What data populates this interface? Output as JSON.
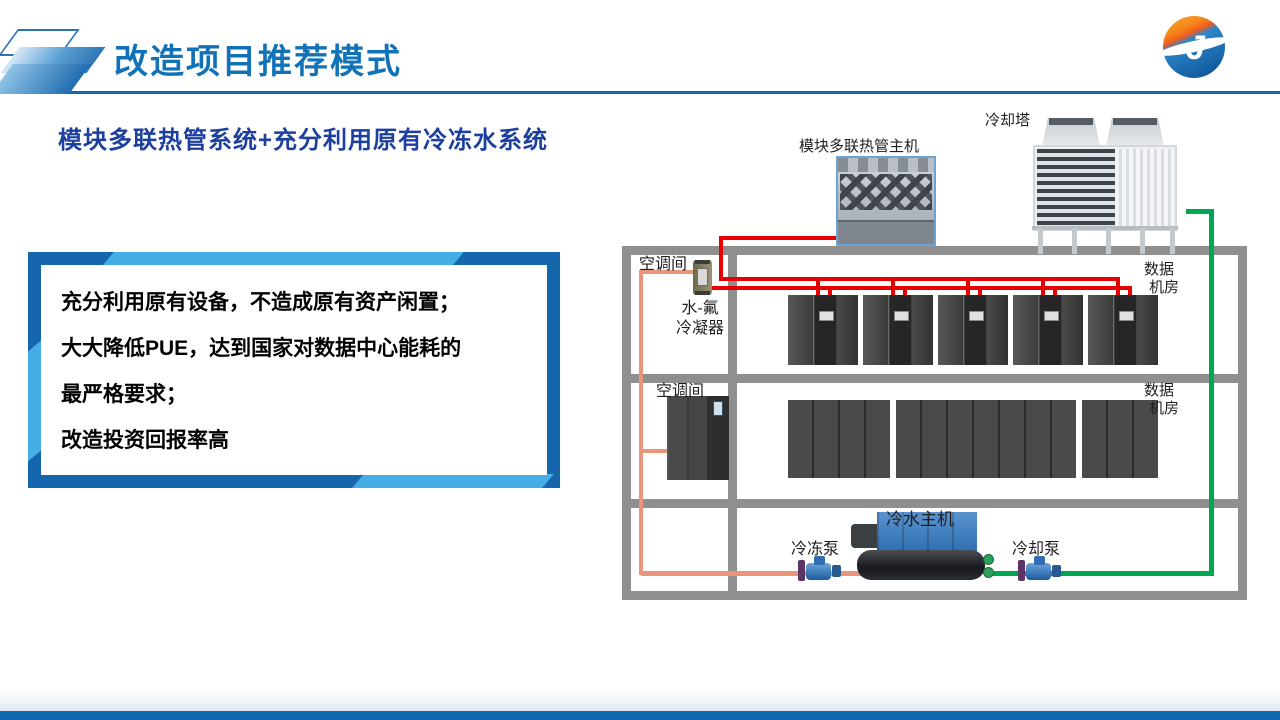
{
  "slide": {
    "title": "改造项目推荐模式",
    "subtitle": "模块多联热管系统+充分利用原有冷冻水系统",
    "logo_glyph": "J"
  },
  "highlight_box": {
    "lines": [
      "充分利用原有设备，不造成原有资产闲置；",
      "大大降低PUE，达到国家对数据中心能耗的",
      "最严格要求；",
      "改造投资回报率高"
    ]
  },
  "diagram": {
    "labels": {
      "module_unit": "模块多联热管主机",
      "cooling_tower": "冷却塔",
      "ac_room_row1": "空调间",
      "ac_room_row2": "空调间",
      "condenser_line1": "水-氟",
      "condenser_line2": "冷凝器",
      "data_room_row1_line1": "数据",
      "data_room_row1_line2": "机房",
      "data_room_row2_line1": "数据",
      "data_room_row2_line2": "机房",
      "chiller": "冷水主机",
      "chilled_pump": "冷冻泵",
      "cooling_pump": "冷却泵"
    },
    "colors": {
      "refrigerant_pipe": "#e60000",
      "chilled_water_pipe": "#e8957a",
      "cooling_water_pipe": "#00a651",
      "wall": "#8f8f8f"
    },
    "rack_row1_groups": 5,
    "rack_row2_group_cols": [
      4,
      7,
      3
    ]
  },
  "theme": {
    "title_color": "#1172b8",
    "subtitle_color": "#1d3f9d",
    "accent_bar": "#0d6ab1",
    "frame_dark": "#1566ad",
    "frame_light": "#45aee4"
  }
}
